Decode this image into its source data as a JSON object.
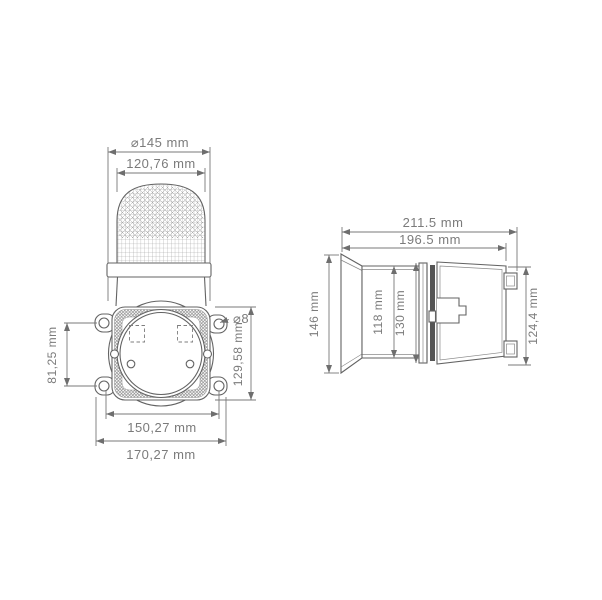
{
  "drawing": {
    "front": {
      "lens_diameter": "⌀145 mm",
      "lens_width": "120,76 mm",
      "hole_spacing_vertical": "81,25 mm",
      "hole_diameter": "⌀8",
      "flange_height": "129,58 mm",
      "hole_spacing_horizontal": "150,27 mm",
      "overall_width": "170,27 mm"
    },
    "side": {
      "overall_length": "211.5 mm",
      "length_to_flange": "196.5 mm",
      "lens_face_height": "146 mm",
      "opening_height": "118 mm",
      "flange_plate_height": "130 mm",
      "body_height": "124,4 mm"
    },
    "colors": {
      "object_line": "#636363",
      "dimension_line": "#787878",
      "label_text": "#7b7b7b",
      "gasket_fill": "#555555"
    }
  }
}
